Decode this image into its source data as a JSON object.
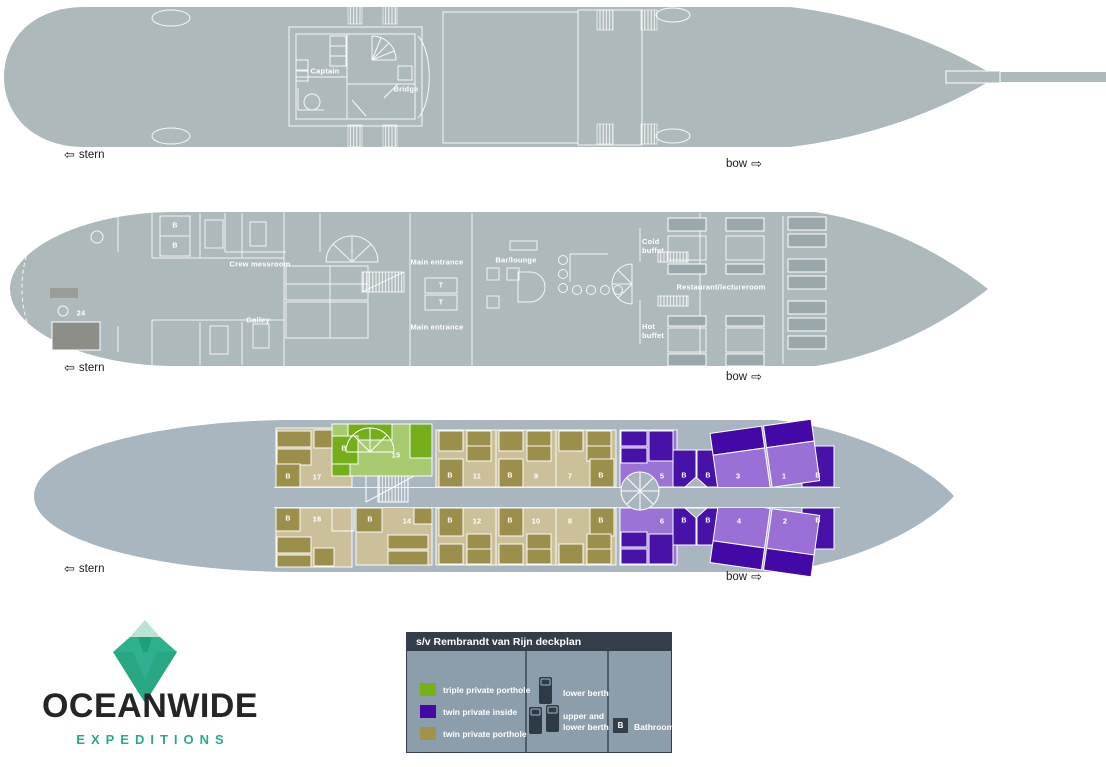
{
  "directions": {
    "stern": "stern",
    "bow": "bow",
    "arrow_left": "⇦",
    "arrow_right": "⇨"
  },
  "markers": {
    "bathroom": "B",
    "table": "T"
  },
  "upper_deck": {
    "rooms": {
      "captain": "Captain",
      "bridge": "Bridge"
    }
  },
  "main_deck": {
    "rooms": {
      "crew_messroom": "Crew messroom",
      "galley": "Galley",
      "main_entrance_top": "Main entrance",
      "main_entrance_bottom": "Main entrance",
      "bar_lounge": "Bar/lounge",
      "cold_buffet": "Cold buffet",
      "hot_buffet": "Hot buffet",
      "restaurant": "Restaurant/lectureroom",
      "cabin_24": "24"
    }
  },
  "cabin_deck": {
    "cabins": [
      {
        "number": "17",
        "type": "twin private porthole"
      },
      {
        "number": "18",
        "type": "twin private porthole"
      },
      {
        "number": "15",
        "type": "triple private porthole"
      },
      {
        "number": "14",
        "type": "twin private porthole"
      },
      {
        "number": "11",
        "type": "twin private porthole"
      },
      {
        "number": "9",
        "type": "twin private porthole"
      },
      {
        "number": "7",
        "type": "twin private porthole"
      },
      {
        "number": "12",
        "type": "twin private porthole"
      },
      {
        "number": "10",
        "type": "twin private porthole"
      },
      {
        "number": "8",
        "type": "twin private porthole"
      },
      {
        "number": "5",
        "type": "twin private inside"
      },
      {
        "number": "3",
        "type": "twin private inside"
      },
      {
        "number": "1",
        "type": "twin private inside"
      },
      {
        "number": "6",
        "type": "twin private inside"
      },
      {
        "number": "4",
        "type": "twin private inside"
      },
      {
        "number": "2",
        "type": "twin private inside"
      }
    ]
  },
  "legend": {
    "title": "s/v Rembrandt van Rijn deckplan",
    "items": [
      {
        "label": "triple private porthole",
        "color": "#76b117"
      },
      {
        "label": "twin private inside",
        "color": "#4309a6"
      },
      {
        "label": "twin private porthole",
        "color": "#a39249"
      }
    ],
    "berths": [
      {
        "label": "lower berth"
      },
      {
        "label": "upper and lower berth"
      }
    ],
    "bathroom": {
      "marker": "B",
      "label": "Bathroom"
    }
  },
  "logo": {
    "name": "OCEANWIDE",
    "tagline": "EXPEDITIONS"
  },
  "colors": {
    "hull": "#aeb9bc",
    "hull_cabin_deck": "#a9b5bf",
    "triple_porthole_dark": "#72ae12",
    "triple_porthole_light": "#a8cd6d",
    "twin_inside_dark": "#4309a6",
    "twin_inside_light": "#9b70d6",
    "twin_porthole_dark": "#9c8c45",
    "twin_porthole_light": "#cdc199",
    "legend_header": "#333e4a",
    "logo_teal": "#2aa98c"
  }
}
